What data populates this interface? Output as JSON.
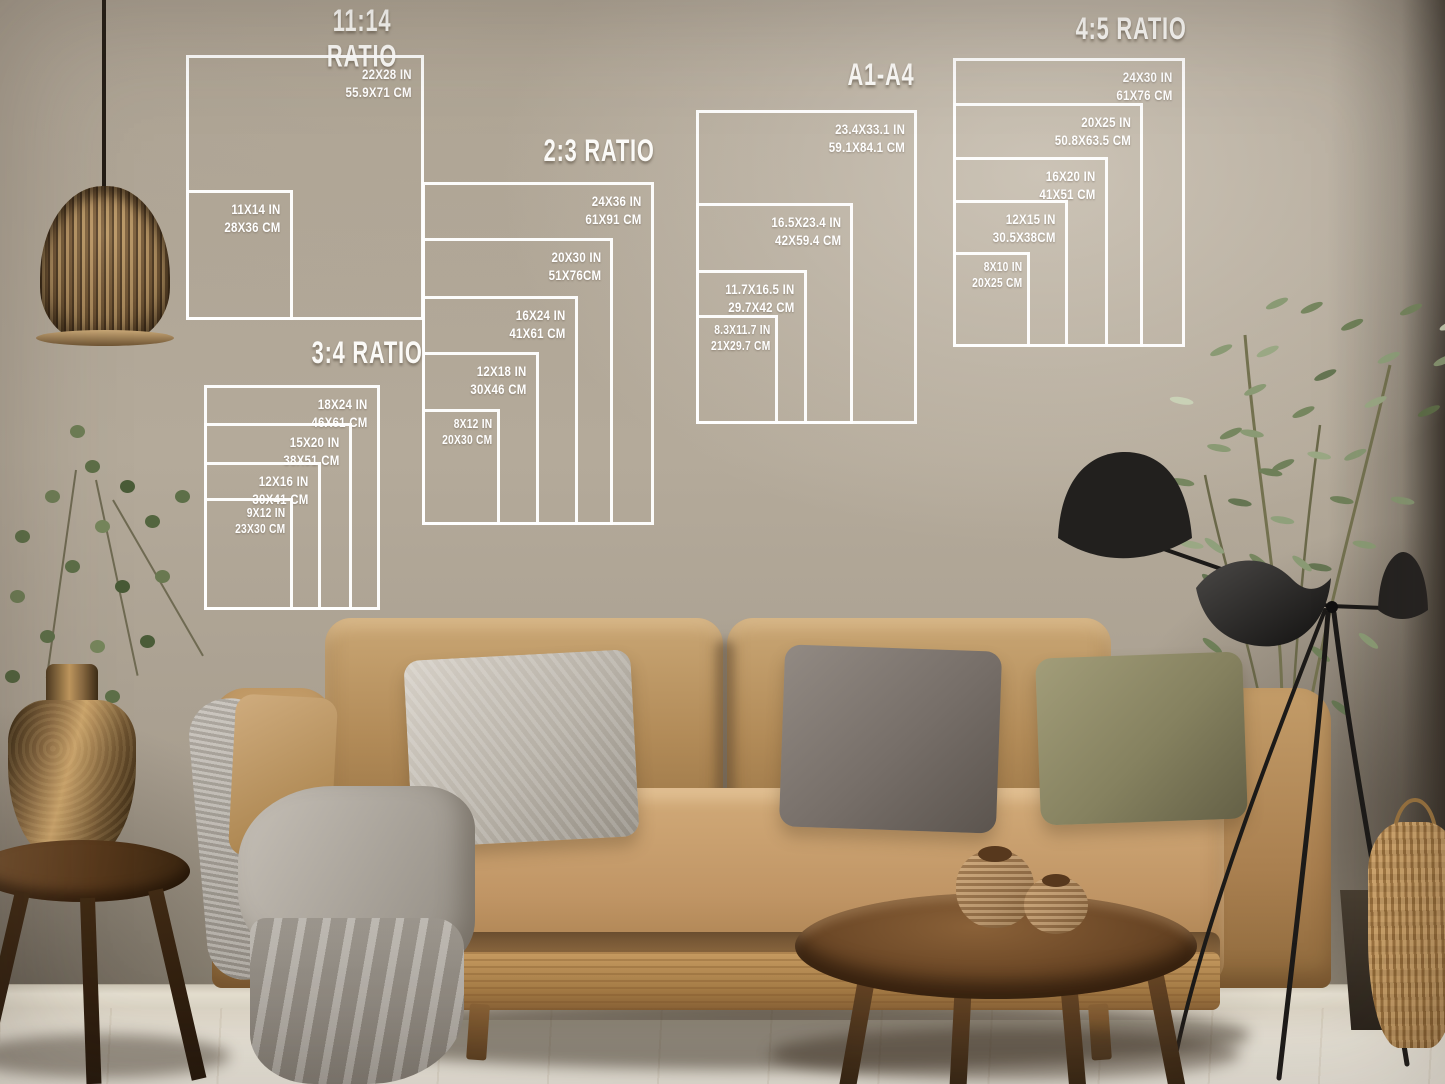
{
  "size_guide": {
    "line_color": "#ffffff",
    "groups": [
      {
        "title": "11:14 RATIO",
        "sizes": [
          {
            "in": "22X28 IN",
            "cm": "55.9X71 CM"
          },
          {
            "in": "11X14 IN",
            "cm": "28X36 CM"
          }
        ]
      },
      {
        "title": "2:3 RATIO",
        "sizes": [
          {
            "in": "24X36 IN",
            "cm": "61X91 CM"
          },
          {
            "in": "20X30 IN",
            "cm": "51X76CM"
          },
          {
            "in": "16X24 IN",
            "cm": "41X61 CM"
          },
          {
            "in": "12X18 IN",
            "cm": "30X46 CM"
          },
          {
            "in": "8X12 IN",
            "cm": "20X30 CM"
          }
        ]
      },
      {
        "title": "3:4 RATIO",
        "sizes": [
          {
            "in": "18X24 IN",
            "cm": "46X61 CM"
          },
          {
            "in": "15X20 IN",
            "cm": "38X51 CM"
          },
          {
            "in": "12X16 IN",
            "cm": "30X41 CM"
          },
          {
            "in": "9X12 IN",
            "cm": "23X30 CM"
          }
        ]
      },
      {
        "title": "A1-A4",
        "sizes": [
          {
            "in": "23.4X33.1 IN",
            "cm": "59.1X84.1 CM"
          },
          {
            "in": "16.5X23.4 IN",
            "cm": "42X59.4 CM"
          },
          {
            "in": "11.7X16.5 IN",
            "cm": "29.7X42 CM"
          },
          {
            "in": "8.3X11.7 IN",
            "cm": "21X29.7 CM"
          }
        ]
      },
      {
        "title": "4:5 RATIO",
        "sizes": [
          {
            "in": "24X30 IN",
            "cm": "61X76 CM"
          },
          {
            "in": "20X25 IN",
            "cm": "50.8X63.5 CM"
          },
          {
            "in": "16X20 IN",
            "cm": "41X51 CM"
          },
          {
            "in": "12X15 IN",
            "cm": "30.5X38CM"
          },
          {
            "in": "8X10 IN",
            "cm": "20X25 CM"
          }
        ]
      }
    ]
  },
  "scene": {
    "palette": {
      "wall": "#b4aa9a",
      "overlay_lines": "#ffffff",
      "sofa": "#b98f5d",
      "pillow_light_gray": "#c2bcb3",
      "pillow_charcoal": "#736c66",
      "pillow_olive": "#85815f",
      "blanket_gray": "#a49e96",
      "wood_dark": "#6b4726",
      "foliage_green": "#76865f",
      "lamp_black": "#1f1d1b",
      "vase_bronze": "#8a6a42",
      "floor": "#eae5d9"
    }
  }
}
